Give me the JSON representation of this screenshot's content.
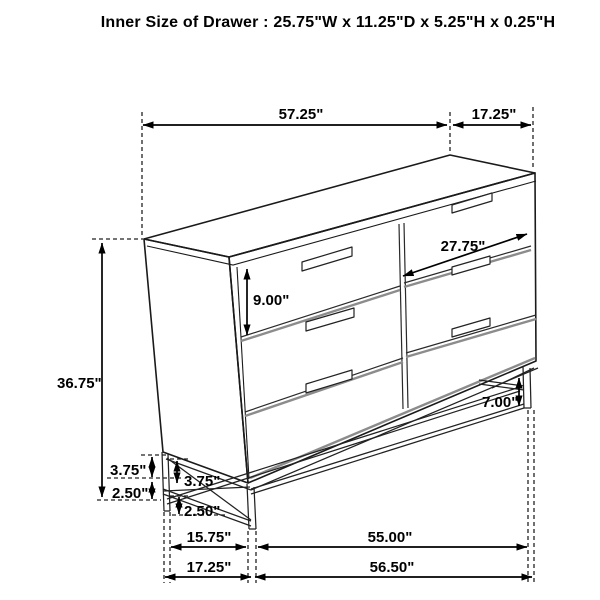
{
  "title": "Inner Size of Drawer : 25.75\"W x 11.25\"D x 5.25\"H x 0.25\"H",
  "colors": {
    "line": "#1a1a1a",
    "shadow": "#8c8c8c",
    "background": "#ffffff"
  },
  "dims": {
    "top_width": "57.25\"",
    "top_depth": "17.25\"",
    "overall_height": "36.75\"",
    "drawer_front_height": "9.00\"",
    "drawer_width": "27.75\"",
    "leg_height": "7.00\"",
    "frame_upper_outer": "3.75\"",
    "frame_lower_outer": "2.50\"",
    "frame_upper_inner": "3.75\"",
    "frame_lower_inner": "2.50\"",
    "base_side_inner": "15.75\"",
    "base_front_inner": "55.00\"",
    "base_side_outer": "17.25\"",
    "base_front_outer": "56.50\""
  }
}
